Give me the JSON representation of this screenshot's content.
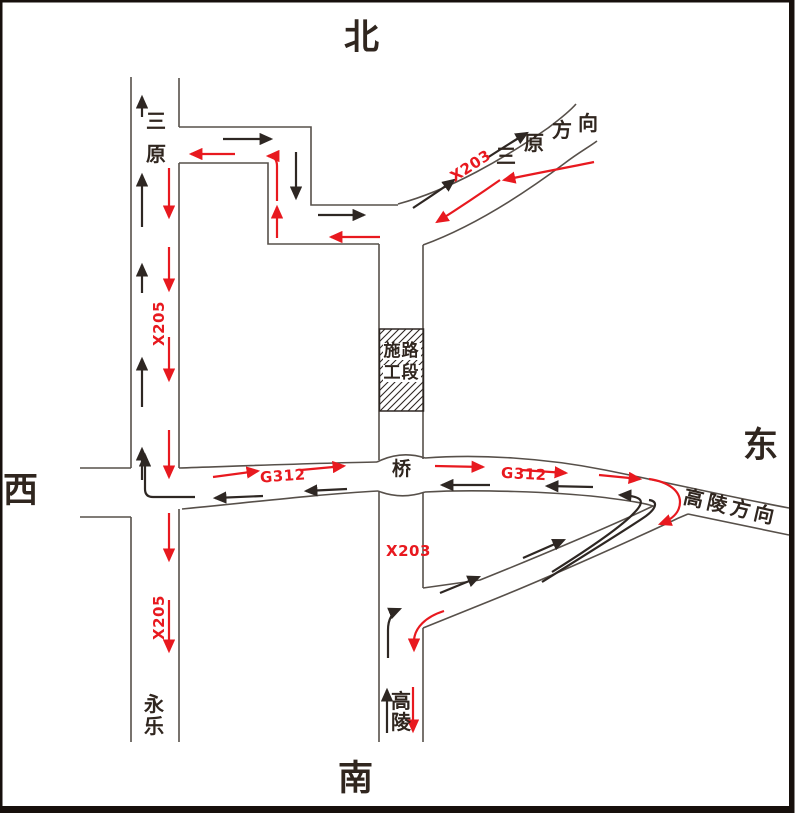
{
  "diagram": {
    "compass": {
      "north": "北",
      "south": "南",
      "east": "东",
      "west": "西"
    },
    "roads": {
      "x205": "X205",
      "x203": "X203",
      "g312": "G312"
    },
    "places": {
      "sanyuan": {
        "full": "三原",
        "chars": [
          "三",
          "原"
        ]
      },
      "yongle": {
        "full": "永乐",
        "chars": [
          "永",
          "乐"
        ]
      },
      "gaoling": {
        "full": "高陵",
        "chars": [
          "高",
          "陵"
        ]
      },
      "bridge": "桥"
    },
    "directions": {
      "sanyuan_direction": {
        "full": "三原方向",
        "chars": [
          "三",
          "原",
          "方",
          "向"
        ]
      },
      "gaoling_direction": "高陵方向"
    },
    "construction_zone": {
      "full": "施工路段",
      "rows": [
        "施路",
        "工段"
      ]
    }
  },
  "colors": {
    "detour_red": "#e8191f",
    "through_black": "#2e2723",
    "road_line": "#57504a",
    "ink": "#30261f"
  }
}
